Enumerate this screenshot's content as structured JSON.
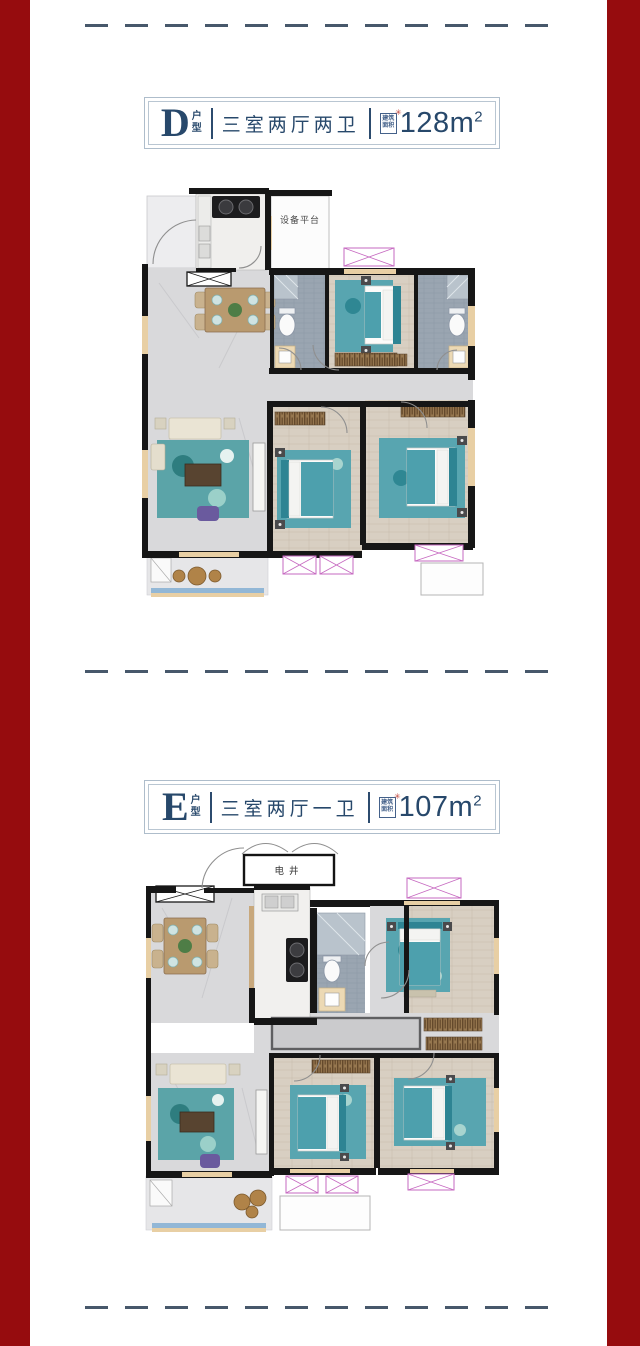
{
  "theme": {
    "side_border_color": "#960c0e",
    "divider_color": "#47586b",
    "title_navy": "#27486b",
    "stamp_red": "#c2453a",
    "bed_teal": "#4da0ad",
    "wall_black": "#161616",
    "window_pink": "#c668c0",
    "window_sill_beige": "#e8cfa4"
  },
  "units": [
    {
      "letter": "D",
      "type_label_top": "户",
      "type_label_bottom": "型",
      "rooms_label": "三室两厅两卫",
      "stamp_top": "建筑",
      "stamp_bottom": "面积",
      "stamp_mark": "✳",
      "area_value": "128m",
      "area_exp": "2",
      "plan_label": "设备平台"
    },
    {
      "letter": "E",
      "type_label_top": "户",
      "type_label_bottom": "型",
      "rooms_label": "三室两厅一卫",
      "stamp_top": "建筑",
      "stamp_bottom": "面积",
      "stamp_mark": "✳",
      "area_value": "107m",
      "area_exp": "2",
      "plan_label": "电井"
    }
  ]
}
